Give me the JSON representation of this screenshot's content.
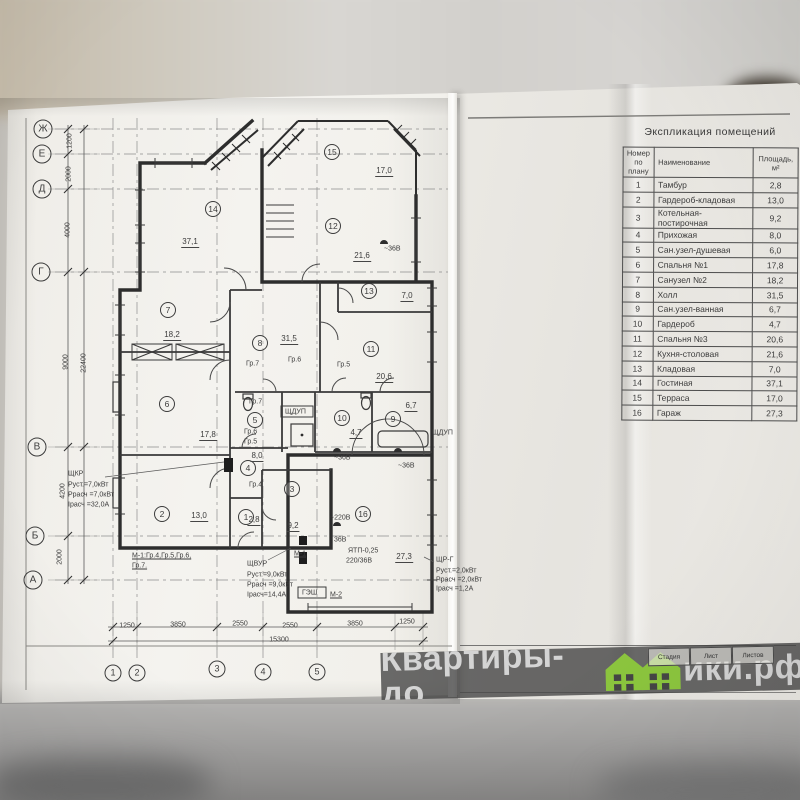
{
  "explication": {
    "title": "Экспликация помещений",
    "columns": [
      "Номер по плану",
      "Наименование",
      "Площадь, м²"
    ],
    "rows": [
      {
        "n": "1",
        "name": "Тамбур",
        "area": "2,8"
      },
      {
        "n": "2",
        "name": "Гардероб-кладовая",
        "area": "13,0"
      },
      {
        "n": "3",
        "name": "Котельная-постирочная",
        "area": "9,2"
      },
      {
        "n": "4",
        "name": "Прихожая",
        "area": "8,0"
      },
      {
        "n": "5",
        "name": "Сан.узел-душевая",
        "area": "6,0"
      },
      {
        "n": "6",
        "name": "Спальня №1",
        "area": "17,8"
      },
      {
        "n": "7",
        "name": "Санузел №2",
        "area": "18,2"
      },
      {
        "n": "8",
        "name": "Холл",
        "area": "31,5"
      },
      {
        "n": "9",
        "name": "Сан.узел-ванная",
        "area": "6,7"
      },
      {
        "n": "10",
        "name": "Гардероб",
        "area": "4,7"
      },
      {
        "n": "11",
        "name": "Спальня №3",
        "area": "20,6"
      },
      {
        "n": "12",
        "name": "Кухня-столовая",
        "area": "21,6"
      },
      {
        "n": "13",
        "name": "Кладовая",
        "area": "7,0"
      },
      {
        "n": "14",
        "name": "Гостиная",
        "area": "37,1"
      },
      {
        "n": "15",
        "name": "Терраса",
        "area": "17,0"
      },
      {
        "n": "16",
        "name": "Гараж",
        "area": "27,3"
      }
    ]
  },
  "titleblock": {
    "cells": [
      "Стадия",
      "Лист",
      "Листов"
    ]
  },
  "watermark": {
    "left": "Квартиры-до",
    "right": "ики.рф",
    "green": "#8cc63e"
  },
  "plan": {
    "axis_rows": [
      {
        "l": "Ж",
        "x": 43,
        "y": 129
      },
      {
        "l": "Е",
        "x": 42,
        "y": 154
      },
      {
        "l": "Д",
        "x": 42,
        "y": 189
      },
      {
        "l": "Г",
        "x": 41,
        "y": 272
      },
      {
        "l": "В",
        "x": 37,
        "y": 447
      },
      {
        "l": "Б",
        "x": 35,
        "y": 536
      },
      {
        "l": "А",
        "x": 33,
        "y": 580
      }
    ],
    "axis_cols": [
      {
        "l": "1",
        "x": 113,
        "y": 673
      },
      {
        "l": "2",
        "x": 137,
        "y": 673
      },
      {
        "l": "3",
        "x": 217,
        "y": 669
      },
      {
        "l": "4",
        "x": 263,
        "y": 672
      },
      {
        "l": "5",
        "x": 317,
        "y": 672
      }
    ],
    "rooms": [
      {
        "n": "14",
        "x": 213,
        "y": 209
      },
      {
        "n": "15",
        "x": 332,
        "y": 152
      },
      {
        "n": "12",
        "x": 333,
        "y": 226
      },
      {
        "n": "13",
        "x": 369,
        "y": 291
      },
      {
        "n": "11",
        "x": 371,
        "y": 349
      },
      {
        "n": "8",
        "x": 260,
        "y": 343
      },
      {
        "n": "7",
        "x": 168,
        "y": 310
      },
      {
        "n": "6",
        "x": 167,
        "y": 404
      },
      {
        "n": "10",
        "x": 342,
        "y": 418
      },
      {
        "n": "9",
        "x": 393,
        "y": 419
      },
      {
        "n": "5",
        "x": 255,
        "y": 420
      },
      {
        "n": "4",
        "x": 248,
        "y": 468
      },
      {
        "n": "3",
        "x": 292,
        "y": 489
      },
      {
        "n": "1",
        "x": 246,
        "y": 517
      },
      {
        "n": "2",
        "x": 162,
        "y": 514
      },
      {
        "n": "16",
        "x": 363,
        "y": 514
      }
    ],
    "areas": [
      {
        "t": "37,1",
        "x": 190,
        "y": 243
      },
      {
        "t": "17,0",
        "x": 384,
        "y": 172
      },
      {
        "t": "21,6",
        "x": 362,
        "y": 257
      },
      {
        "t": "7,0",
        "x": 407,
        "y": 297
      },
      {
        "t": "20,6",
        "x": 384,
        "y": 378
      },
      {
        "t": "31,5",
        "x": 289,
        "y": 340
      },
      {
        "t": "18,2",
        "x": 172,
        "y": 336
      },
      {
        "t": "17,8",
        "x": 208,
        "y": 436
      },
      {
        "t": "4,7",
        "x": 356,
        "y": 434
      },
      {
        "t": "6,7",
        "x": 411,
        "y": 407
      },
      {
        "t": "8,0",
        "x": 257,
        "y": 457
      },
      {
        "t": "9,2",
        "x": 293,
        "y": 527
      },
      {
        "t": "2,8",
        "x": 254,
        "y": 521
      },
      {
        "t": "13,0",
        "x": 199,
        "y": 517
      },
      {
        "t": "27,3",
        "x": 404,
        "y": 558
      }
    ],
    "dims_v": [
      {
        "t": "1200",
        "x": 70,
        "y": 141
      },
      {
        "t": "2000",
        "x": 69,
        "y": 174
      },
      {
        "t": "4000",
        "x": 68,
        "y": 230
      },
      {
        "t": "9000",
        "x": 66,
        "y": 362
      },
      {
        "t": "22400",
        "x": 84,
        "y": 363
      },
      {
        "t": "4200",
        "x": 63,
        "y": 491
      },
      {
        "t": "2000",
        "x": 60,
        "y": 557
      }
    ],
    "dims_h": [
      {
        "t": "1250",
        "x": 127,
        "y": 626
      },
      {
        "t": "3850",
        "x": 178,
        "y": 625
      },
      {
        "t": "2550",
        "x": 240,
        "y": 624
      },
      {
        "t": "2550",
        "x": 290,
        "y": 626
      },
      {
        "t": "3850",
        "x": 355,
        "y": 624
      },
      {
        "t": "1250",
        "x": 407,
        "y": 622
      },
      {
        "t": "15300",
        "x": 279,
        "y": 640
      }
    ],
    "annotations": [
      {
        "t": "ЩКР",
        "x": 68,
        "y": 474
      },
      {
        "t": "Руст.=7,0кВт",
        "x": 68,
        "y": 485
      },
      {
        "t": "Ррасч =7,0кВт",
        "x": 68,
        "y": 495
      },
      {
        "t": "Iрасч =32,0А",
        "x": 68,
        "y": 505
      },
      {
        "t": "М-1:Гр.4,Гр.5,Гр.6,",
        "x": 132,
        "y": 556,
        "u": 1
      },
      {
        "t": "Гр.7.",
        "x": 132,
        "y": 566,
        "u": 1
      },
      {
        "t": "ЩВУР",
        "x": 247,
        "y": 564
      },
      {
        "t": "Руст.=9,0кВт",
        "x": 247,
        "y": 575
      },
      {
        "t": "Ррасч =9,0кВт",
        "x": 247,
        "y": 585
      },
      {
        "t": "Iрасч=14,4А",
        "x": 247,
        "y": 595
      },
      {
        "t": "М-1",
        "x": 294,
        "y": 554,
        "u": 1
      },
      {
        "t": "ГЭШ",
        "x": 302,
        "y": 593
      },
      {
        "t": "М-2",
        "x": 330,
        "y": 595,
        "u": 1
      },
      {
        "t": "ЯТП-0,25",
        "x": 348,
        "y": 551
      },
      {
        "t": "220/36В",
        "x": 346,
        "y": 561
      },
      {
        "t": "ЩР-Г",
        "x": 436,
        "y": 560
      },
      {
        "t": "Руст.=2,0кВт",
        "x": 436,
        "y": 571
      },
      {
        "t": "Ррасч =2,0кВт",
        "x": 436,
        "y": 580
      },
      {
        "t": "Iрасч =1,2А",
        "x": 436,
        "y": 589
      },
      {
        "t": "ЩДУП",
        "x": 285,
        "y": 412
      },
      {
        "t": "ЩДУП",
        "x": 432,
        "y": 433
      },
      {
        "t": "~220В",
        "x": 330,
        "y": 518
      },
      {
        "t": "~36В",
        "x": 334,
        "y": 458
      },
      {
        "t": "~36В",
        "x": 398,
        "y": 466
      },
      {
        "t": "36В",
        "x": 334,
        "y": 540
      },
      {
        "t": "~36В",
        "x": 384,
        "y": 249
      },
      {
        "t": "Гр.7",
        "x": 246,
        "y": 364
      },
      {
        "t": "Гр.6",
        "x": 288,
        "y": 360
      },
      {
        "t": "Гр.5",
        "x": 337,
        "y": 365
      },
      {
        "t": "Гр.7",
        "x": 249,
        "y": 402
      },
      {
        "t": "Гр.6",
        "x": 244,
        "y": 432
      },
      {
        "t": "Гр.5",
        "x": 244,
        "y": 442
      },
      {
        "t": "Гр.4",
        "x": 249,
        "y": 485
      }
    ]
  }
}
